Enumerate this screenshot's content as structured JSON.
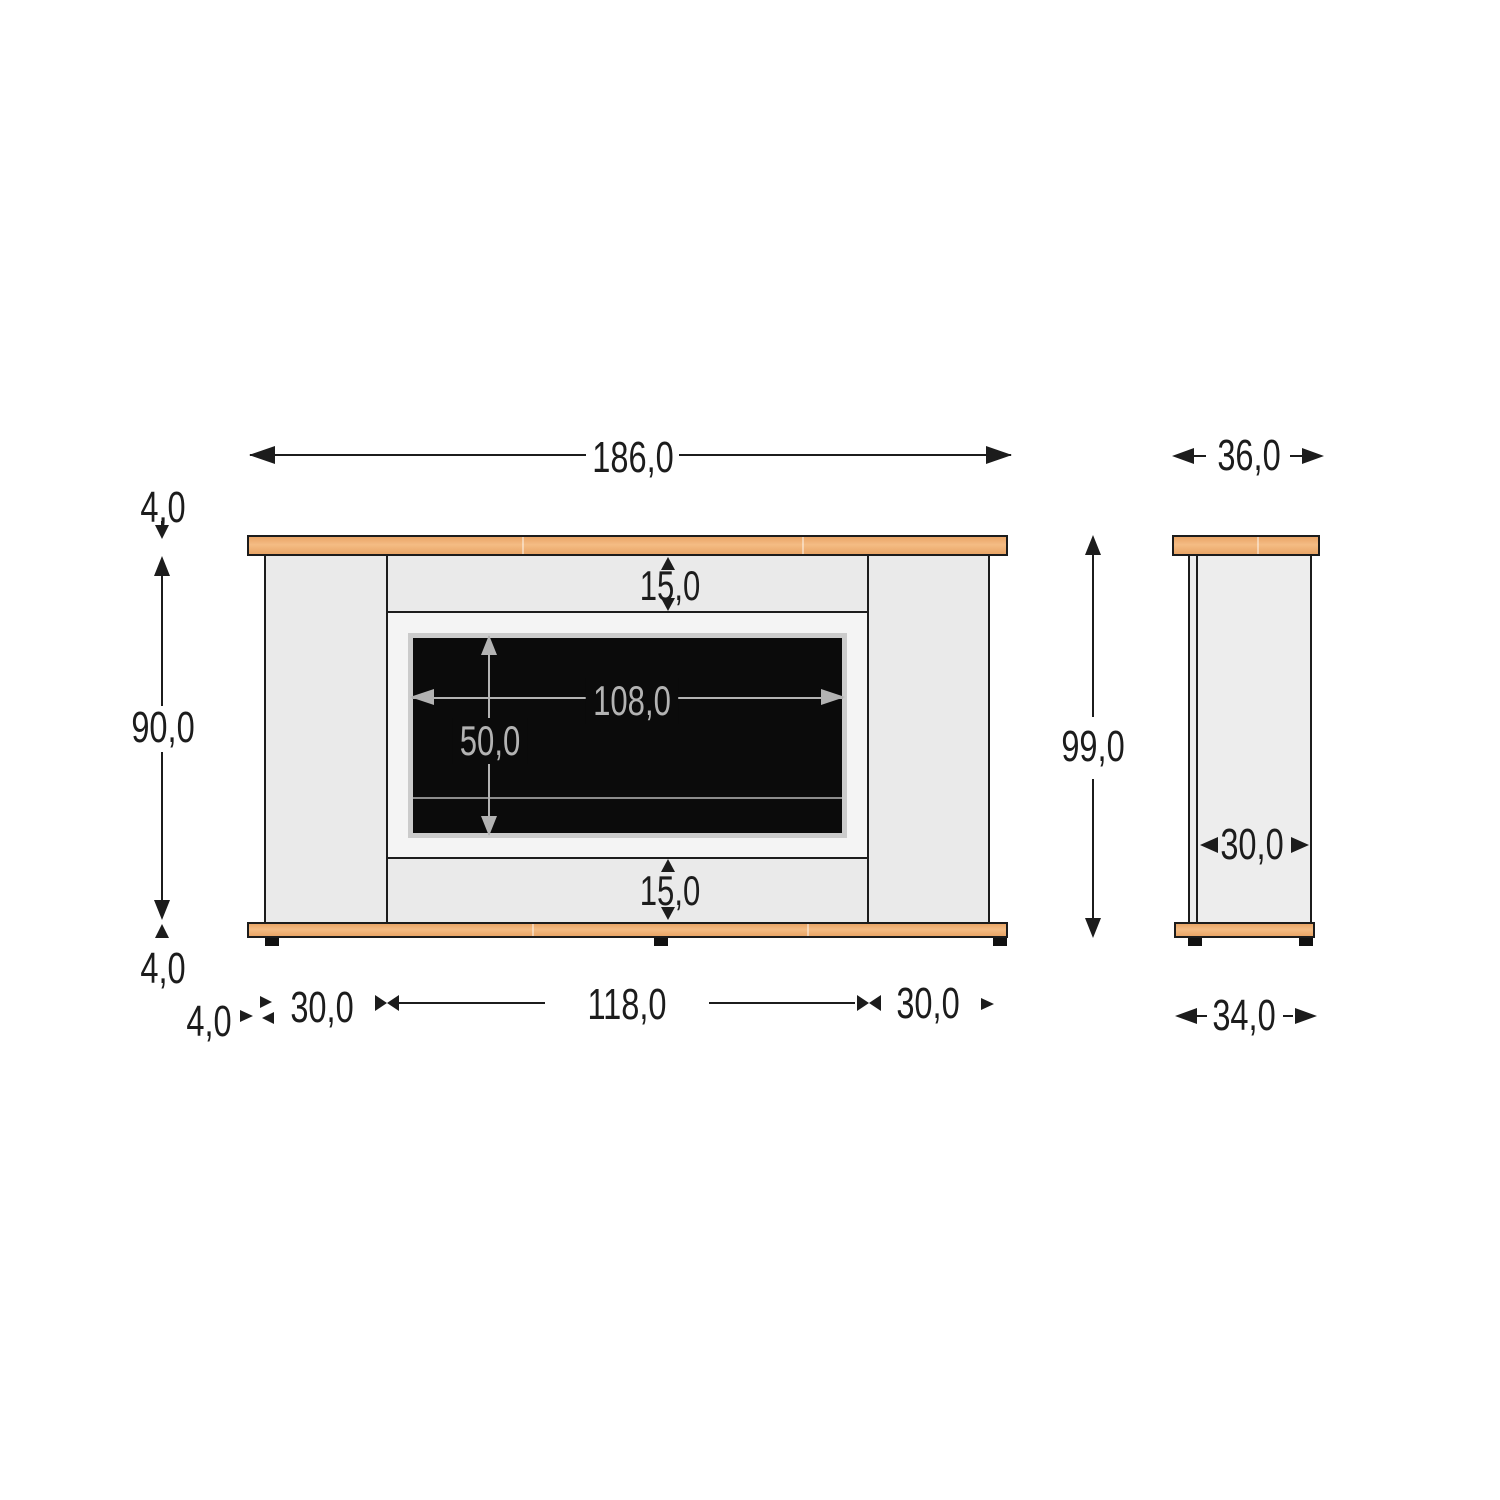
{
  "front": {
    "width_overall": "186,0",
    "top_board_thickness": "4,0",
    "body_height": "90,0",
    "base_board_thickness": "4,0",
    "top_rail_height": "15,0",
    "bottom_rail_height": "15,0",
    "screen_width": "108,0",
    "screen_height": "50,0",
    "base_overhang": "4,0",
    "left_column_width": "30,0",
    "opening_width": "118,0",
    "right_column_width": "30,0"
  },
  "side": {
    "top_board_depth": "36,0",
    "height_overall": "99,0",
    "body_depth": "30,0",
    "base_board_depth": "34,0"
  },
  "colors": {
    "line": "#1c1c1c",
    "wood": "#e9a566",
    "wood_hi": "#f4bc84",
    "body": "#eaeaea",
    "panel": "#f4f4f4",
    "screen": "#0b0b0b",
    "dim_gray": "#b3b3b3"
  }
}
